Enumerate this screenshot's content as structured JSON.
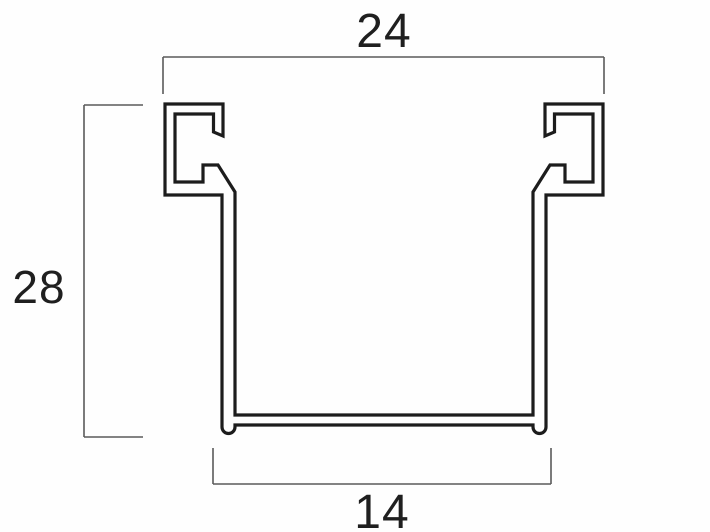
{
  "figure": {
    "background_color": "#fefefe",
    "profile_line_color": "#1c1c1c",
    "dimension_line_color": "#5a5a5a",
    "text_color": "#1f1f1f",
    "dimensions": {
      "top_width": "24",
      "left_height": "28",
      "bottom_width": "14"
    }
  }
}
